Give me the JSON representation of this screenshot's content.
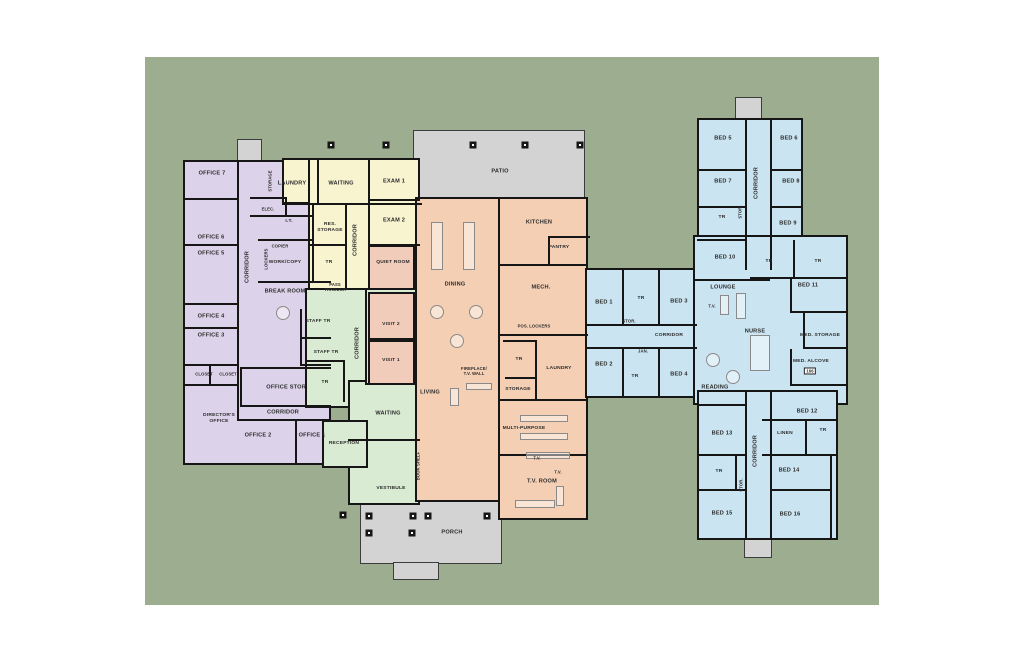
{
  "canvas": {
    "width": 1024,
    "height": 663,
    "page_bg": "#ffffff"
  },
  "site": {
    "x": 145,
    "y": 57,
    "w": 734,
    "h": 548,
    "bg": "#9DAE90"
  },
  "palette": {
    "offices": "#DCD3EA",
    "clinic": "#F8F4D0",
    "entry": "#D9EBD3",
    "common": "#F4CFB3",
    "visit_rooms": "#F2CCBB",
    "residential": "#CBE4F1",
    "outdoor": "#D3D3D3",
    "wall": "#161616",
    "label": "#2B2B2B"
  },
  "zones": [
    {
      "name": "office-entry-stub",
      "color": "#D3D3D3",
      "outdoor": true,
      "rect": [
        237,
        139,
        25,
        23
      ]
    },
    {
      "name": "right-wing-top-stub",
      "color": "#D3D3D3",
      "outdoor": true,
      "rect": [
        735,
        97,
        27,
        23
      ]
    },
    {
      "name": "right-wing-bottom-stub",
      "color": "#D3D3D3",
      "outdoor": true,
      "rect": [
        744,
        538,
        28,
        20
      ]
    },
    {
      "name": "patio",
      "color": "#D3D3D3",
      "outdoor": true,
      "rect": [
        413,
        130,
        172,
        70
      ]
    },
    {
      "name": "porch",
      "color": "#D3D3D3",
      "outdoor": true,
      "rect": [
        360,
        500,
        142,
        64
      ]
    },
    {
      "name": "porch-stub",
      "color": "#D3D3D3",
      "outdoor": true,
      "rect": [
        393,
        562,
        46,
        18
      ]
    },
    {
      "name": "office-wing",
      "color": "#DCD3EA",
      "rect": [
        183,
        160,
        148,
        305
      ]
    },
    {
      "name": "clinic-top-strip",
      "color": "#F8F4D0",
      "rect": [
        282,
        158,
        138,
        46
      ]
    },
    {
      "name": "clinic-main",
      "color": "#F8F4D0",
      "rect": [
        308,
        158,
        112,
        132
      ]
    },
    {
      "name": "entry-corridor",
      "color": "#D9EBD3",
      "rect": [
        305,
        288,
        65,
        120
      ]
    },
    {
      "name": "entry-waiting-vestibule",
      "color": "#D9EBD3",
      "rect": [
        348,
        380,
        72,
        125
      ]
    },
    {
      "name": "reception",
      "color": "#D9EBD3",
      "rect": [
        322,
        420,
        46,
        48
      ]
    },
    {
      "name": "visit-column",
      "color": "#D9EBD3",
      "rect": [
        365,
        288,
        55,
        97
      ]
    },
    {
      "name": "quiet-room",
      "color": "#F2CCBB",
      "rect": [
        368,
        245,
        47,
        45
      ]
    },
    {
      "name": "visit-2-room",
      "color": "#F2CCBB",
      "rect": [
        368,
        292,
        47,
        48
      ]
    },
    {
      "name": "visit-1-room",
      "color": "#F2CCBB",
      "rect": [
        368,
        340,
        47,
        45
      ]
    },
    {
      "name": "common-west",
      "color": "#F4CFB3",
      "rect": [
        415,
        197,
        90,
        305
      ]
    },
    {
      "name": "common-east",
      "color": "#F4CFB3",
      "rect": [
        498,
        197,
        90,
        323
      ]
    },
    {
      "name": "bed-connector",
      "color": "#CBE4F1",
      "rect": [
        585,
        268,
        112,
        130
      ]
    },
    {
      "name": "right-wing-top",
      "color": "#CBE4F1",
      "rect": [
        697,
        118,
        106,
        152
      ]
    },
    {
      "name": "right-wing-middle",
      "color": "#CBE4F1",
      "rect": [
        693,
        235,
        155,
        170
      ]
    },
    {
      "name": "right-wing-bottom",
      "color": "#CBE4F1",
      "rect": [
        697,
        390,
        141,
        150
      ]
    }
  ],
  "walls": [
    [
      237,
      160,
      2,
      260
    ],
    [
      183,
      198,
      56,
      2
    ],
    [
      183,
      244,
      56,
      2
    ],
    [
      183,
      303,
      56,
      2
    ],
    [
      183,
      327,
      56,
      2
    ],
    [
      183,
      364,
      56,
      2
    ],
    [
      183,
      384,
      56,
      2
    ],
    [
      209,
      364,
      2,
      22
    ],
    [
      237,
      419,
      94,
      2
    ],
    [
      295,
      419,
      2,
      46
    ],
    [
      250,
      197,
      37,
      2
    ],
    [
      285,
      197,
      2,
      20
    ],
    [
      250,
      215,
      62,
      2
    ],
    [
      258,
      239,
      56,
      2
    ],
    [
      312,
      204,
      2,
      78
    ],
    [
      258,
      281,
      73,
      2
    ],
    [
      300,
      309,
      2,
      57
    ],
    [
      300,
      337,
      31,
      2
    ],
    [
      300,
      364,
      31,
      2
    ],
    [
      240,
      367,
      91,
      2
    ],
    [
      240,
      405,
      91,
      2
    ],
    [
      240,
      367,
      2,
      40
    ],
    [
      317,
      158,
      2,
      46
    ],
    [
      282,
      203,
      140,
      2
    ],
    [
      345,
      204,
      2,
      86
    ],
    [
      368,
      158,
      2,
      132
    ],
    [
      368,
      199,
      52,
      2
    ],
    [
      368,
      244,
      52,
      2
    ],
    [
      310,
      244,
      37,
      2
    ],
    [
      348,
      439,
      72,
      2
    ],
    [
      343,
      360,
      2,
      42
    ],
    [
      305,
      360,
      40,
      2
    ],
    [
      548,
      236,
      2,
      29
    ],
    [
      548,
      236,
      42,
      2
    ],
    [
      498,
      264,
      90,
      2
    ],
    [
      498,
      334,
      90,
      2
    ],
    [
      535,
      340,
      2,
      60
    ],
    [
      503,
      340,
      34,
      2
    ],
    [
      505,
      377,
      32,
      2
    ],
    [
      498,
      399,
      90,
      2
    ],
    [
      498,
      454,
      90,
      2
    ],
    [
      585,
      324,
      112,
      2
    ],
    [
      585,
      347,
      112,
      2
    ],
    [
      622,
      268,
      2,
      58
    ],
    [
      658,
      268,
      2,
      58
    ],
    [
      622,
      347,
      2,
      51
    ],
    [
      658,
      347,
      2,
      51
    ],
    [
      745,
      118,
      2,
      152
    ],
    [
      770,
      118,
      2,
      152
    ],
    [
      697,
      169,
      48,
      2
    ],
    [
      770,
      169,
      33,
      2
    ],
    [
      697,
      206,
      48,
      2
    ],
    [
      770,
      206,
      33,
      2
    ],
    [
      697,
      239,
      48,
      2
    ],
    [
      693,
      279,
      77,
      2
    ],
    [
      750,
      277,
      98,
      2
    ],
    [
      793,
      240,
      2,
      38
    ],
    [
      790,
      311,
      58,
      2
    ],
    [
      790,
      277,
      2,
      36
    ],
    [
      803,
      311,
      2,
      38
    ],
    [
      803,
      347,
      45,
      2
    ],
    [
      790,
      349,
      2,
      36
    ],
    [
      790,
      384,
      58,
      2
    ],
    [
      745,
      390,
      2,
      150
    ],
    [
      770,
      390,
      2,
      150
    ],
    [
      762,
      419,
      76,
      2
    ],
    [
      805,
      419,
      2,
      36
    ],
    [
      762,
      454,
      76,
      2
    ],
    [
      697,
      404,
      48,
      2
    ],
    [
      697,
      454,
      48,
      2
    ],
    [
      735,
      454,
      2,
      36
    ],
    [
      697,
      489,
      48,
      2
    ],
    [
      770,
      489,
      60,
      2
    ],
    [
      830,
      454,
      2,
      86
    ]
  ],
  "furniture": [
    {
      "shape": "rect",
      "rect": [
        431,
        222,
        12,
        48
      ]
    },
    {
      "shape": "rect",
      "rect": [
        463,
        222,
        12,
        48
      ]
    },
    {
      "shape": "round",
      "rect": [
        430,
        305,
        14,
        14
      ]
    },
    {
      "shape": "round",
      "rect": [
        469,
        305,
        14,
        14
      ]
    },
    {
      "shape": "round",
      "rect": [
        450,
        334,
        14,
        14
      ]
    },
    {
      "shape": "rect",
      "rect": [
        466,
        383,
        26,
        7
      ]
    },
    {
      "shape": "rect",
      "rect": [
        450,
        388,
        9,
        18
      ]
    },
    {
      "shape": "rect",
      "rect": [
        520,
        415,
        48,
        7
      ]
    },
    {
      "shape": "rect",
      "rect": [
        520,
        433,
        48,
        7
      ]
    },
    {
      "shape": "rect",
      "rect": [
        526,
        452,
        44,
        7
      ]
    },
    {
      "shape": "rect",
      "rect": [
        515,
        500,
        40,
        8
      ]
    },
    {
      "shape": "rect",
      "rect": [
        556,
        486,
        8,
        20
      ]
    },
    {
      "shape": "round",
      "rect": [
        706,
        353,
        14,
        14
      ]
    },
    {
      "shape": "round",
      "rect": [
        726,
        370,
        14,
        14
      ]
    },
    {
      "shape": "rect",
      "rect": [
        750,
        335,
        20,
        36
      ]
    },
    {
      "shape": "rect",
      "rect": [
        720,
        295,
        9,
        20
      ]
    },
    {
      "shape": "rect",
      "rect": [
        736,
        293,
        10,
        26
      ]
    },
    {
      "shape": "round",
      "rect": [
        276,
        306,
        14,
        14
      ]
    }
  ],
  "columns": [
    [
      331,
      145
    ],
    [
      386,
      145
    ],
    [
      473,
      145
    ],
    [
      525,
      145
    ],
    [
      580,
      145
    ],
    [
      343,
      515
    ],
    [
      369,
      516
    ],
    [
      413,
      516
    ],
    [
      428,
      516
    ],
    [
      487,
      516
    ],
    [
      369,
      533
    ],
    [
      412,
      533
    ]
  ],
  "labels": [
    {
      "t": "PATIO",
      "x": 500,
      "y": 172
    },
    {
      "t": "PORCH",
      "x": 452,
      "y": 533
    },
    {
      "t": "OFFICE 7",
      "x": 212,
      "y": 174
    },
    {
      "t": "OFFICE 6",
      "x": 211,
      "y": 238
    },
    {
      "t": "OFFICE 5",
      "x": 211,
      "y": 254
    },
    {
      "t": "OFFICE 4",
      "x": 211,
      "y": 317
    },
    {
      "t": "OFFICE 3",
      "x": 211,
      "y": 336
    },
    {
      "t": "CLOSET",
      "x": 204,
      "y": 374,
      "s": 3
    },
    {
      "t": "CLOSET",
      "x": 228,
      "y": 374,
      "s": 3
    },
    {
      "t": "DIRECTOR'S OFFICE",
      "x": 219,
      "y": 419,
      "w": 36,
      "s": 2
    },
    {
      "t": "OFFICE 2",
      "x": 258,
      "y": 436
    },
    {
      "t": "OFFICE 1",
      "x": 312,
      "y": 436
    },
    {
      "t": "CORRIDOR",
      "x": 248,
      "y": 267,
      "v": true
    },
    {
      "t": "CORRIDOR",
      "x": 283,
      "y": 413
    },
    {
      "t": "STORAGE",
      "x": 270,
      "y": 181,
      "v": true,
      "s": 3
    },
    {
      "t": "ELEC.",
      "x": 268,
      "y": 209,
      "s": 3
    },
    {
      "t": "I.T.",
      "x": 289,
      "y": 222,
      "s": 2
    },
    {
      "t": "COPIER",
      "x": 280,
      "y": 246,
      "s": 3
    },
    {
      "t": "LOCKERS",
      "x": 266,
      "y": 259,
      "v": true,
      "s": 3
    },
    {
      "t": "WORK/COPY",
      "x": 285,
      "y": 263,
      "s": 2
    },
    {
      "t": "BREAK ROOM",
      "x": 285,
      "y": 292
    },
    {
      "t": "STAFF TR",
      "x": 318,
      "y": 322,
      "s": 2
    },
    {
      "t": "STAFF TR",
      "x": 326,
      "y": 353,
      "s": 2
    },
    {
      "t": "OFFICE STOR.",
      "x": 287,
      "y": 388
    },
    {
      "t": "TR",
      "x": 325,
      "y": 383,
      "s": 2
    },
    {
      "t": "LAUNDRY",
      "x": 292,
      "y": 184
    },
    {
      "t": "WAITING",
      "x": 341,
      "y": 184
    },
    {
      "t": "EXAM 1",
      "x": 394,
      "y": 182
    },
    {
      "t": "EXAM 2",
      "x": 394,
      "y": 221
    },
    {
      "t": "RES. STORAGE",
      "x": 330,
      "y": 228,
      "w": 30,
      "s": 2
    },
    {
      "t": "CORRIDOR",
      "x": 356,
      "y": 240,
      "v": true
    },
    {
      "t": "TR",
      "x": 329,
      "y": 263,
      "s": 2
    },
    {
      "t": "QUIET ROOM",
      "x": 393,
      "y": 263,
      "s": 2
    },
    {
      "t": "PASS THROUGH",
      "x": 335,
      "y": 287,
      "w": 32,
      "s": 3
    },
    {
      "t": "VISIT 2",
      "x": 391,
      "y": 325,
      "s": 2
    },
    {
      "t": "VISIT 1",
      "x": 391,
      "y": 361,
      "s": 2
    },
    {
      "t": "CORRIDOR",
      "x": 358,
      "y": 343,
      "v": true
    },
    {
      "t": "WAITING",
      "x": 388,
      "y": 414
    },
    {
      "t": "VESTIBULE",
      "x": 391,
      "y": 489,
      "s": 2
    },
    {
      "t": "RECEPTION",
      "x": 344,
      "y": 444,
      "s": 2
    },
    {
      "t": "DINING",
      "x": 455,
      "y": 285
    },
    {
      "t": "KITCHEN",
      "x": 539,
      "y": 223
    },
    {
      "t": "PANTRY",
      "x": 559,
      "y": 248,
      "s": 2
    },
    {
      "t": "MECH.",
      "x": 541,
      "y": 288
    },
    {
      "t": "POS. LOCKERS",
      "x": 534,
      "y": 326,
      "s": 3
    },
    {
      "t": "TR",
      "x": 519,
      "y": 360,
      "s": 2
    },
    {
      "t": "LAUNDRY",
      "x": 559,
      "y": 369,
      "s": 2
    },
    {
      "t": "STORAGE",
      "x": 518,
      "y": 390,
      "s": 2
    },
    {
      "t": "MULTI-PURPOSE",
      "x": 524,
      "y": 429,
      "s": 2
    },
    {
      "t": "T.V.",
      "x": 537,
      "y": 458,
      "s": 3
    },
    {
      "t": "T.V.",
      "x": 558,
      "y": 472,
      "s": 3
    },
    {
      "t": "T.V. ROOM",
      "x": 542,
      "y": 482
    },
    {
      "t": "LIVING",
      "x": 430,
      "y": 393
    },
    {
      "t": "FIREPLACE/ T.V. WALL",
      "x": 474,
      "y": 371,
      "w": 30,
      "s": 3
    },
    {
      "t": "BOOK SHELF",
      "x": 418,
      "y": 466,
      "v": true,
      "s": 3
    },
    {
      "t": "BED 1",
      "x": 604,
      "y": 303
    },
    {
      "t": "TR",
      "x": 641,
      "y": 299,
      "s": 2
    },
    {
      "t": "BED 3",
      "x": 679,
      "y": 302
    },
    {
      "t": "STOR.",
      "x": 629,
      "y": 321,
      "s": 3
    },
    {
      "t": "CORRIDOR",
      "x": 669,
      "y": 336,
      "s": 2
    },
    {
      "t": "JAN.",
      "x": 643,
      "y": 351,
      "s": 3
    },
    {
      "t": "BED 2",
      "x": 604,
      "y": 365
    },
    {
      "t": "TR",
      "x": 635,
      "y": 377,
      "s": 2
    },
    {
      "t": "BED 4",
      "x": 679,
      "y": 375
    },
    {
      "t": "BED 5",
      "x": 723,
      "y": 139
    },
    {
      "t": "BED 6",
      "x": 789,
      "y": 139
    },
    {
      "t": "BED 7",
      "x": 723,
      "y": 182
    },
    {
      "t": "BED 8",
      "x": 791,
      "y": 182
    },
    {
      "t": "CORRIDOR",
      "x": 757,
      "y": 183,
      "v": true
    },
    {
      "t": "TR",
      "x": 722,
      "y": 218,
      "s": 2
    },
    {
      "t": "STOR.",
      "x": 740,
      "y": 212,
      "v": true,
      "s": 3
    },
    {
      "t": "BED 9",
      "x": 788,
      "y": 224
    },
    {
      "t": "BED 10",
      "x": 725,
      "y": 258
    },
    {
      "t": "TR",
      "x": 769,
      "y": 262,
      "s": 2
    },
    {
      "t": "TR",
      "x": 818,
      "y": 262,
      "s": 2
    },
    {
      "t": "LOUNGE",
      "x": 723,
      "y": 288
    },
    {
      "t": "T.V.",
      "x": 712,
      "y": 306,
      "s": 3
    },
    {
      "t": "BED 11",
      "x": 808,
      "y": 286
    },
    {
      "t": "NURSE",
      "x": 755,
      "y": 332
    },
    {
      "t": "MED. STORAGE",
      "x": 820,
      "y": 336,
      "s": 2
    },
    {
      "t": "MED. ALCOVE",
      "x": 811,
      "y": 362,
      "s": 2
    },
    {
      "t": "166",
      "x": 810,
      "y": 371,
      "s": 3,
      "boxed": true
    },
    {
      "t": "READING",
      "x": 715,
      "y": 388
    },
    {
      "t": "BED 12",
      "x": 807,
      "y": 412
    },
    {
      "t": "BED 13",
      "x": 722,
      "y": 434
    },
    {
      "t": "LINEN",
      "x": 785,
      "y": 434,
      "s": 2
    },
    {
      "t": "TR",
      "x": 823,
      "y": 431,
      "s": 2
    },
    {
      "t": "CORRIDOR",
      "x": 756,
      "y": 451,
      "v": true
    },
    {
      "t": "TR",
      "x": 719,
      "y": 472,
      "s": 2
    },
    {
      "t": "STOR.",
      "x": 741,
      "y": 485,
      "v": true,
      "s": 3
    },
    {
      "t": "BED 14",
      "x": 789,
      "y": 471
    },
    {
      "t": "BED 15",
      "x": 722,
      "y": 514
    },
    {
      "t": "BED 16",
      "x": 790,
      "y": 515
    }
  ]
}
